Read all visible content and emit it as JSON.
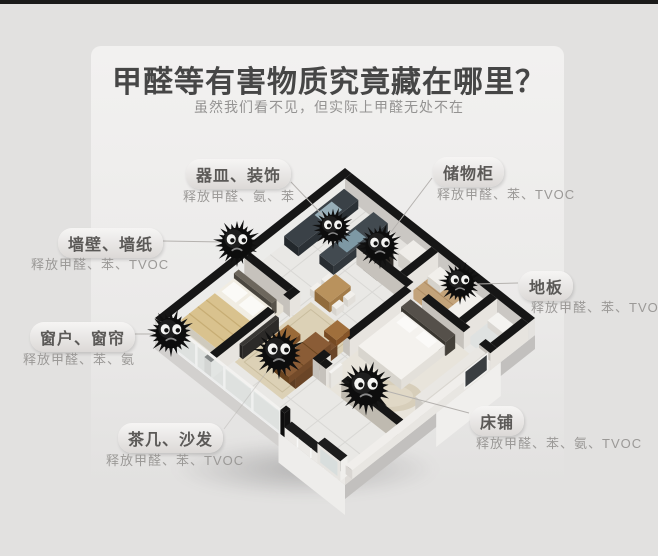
{
  "header": {
    "title": "甲醛等有害物质究竟藏在哪里？",
    "subtitle": "虽然我们看不见，但实际上甲醛无处不在"
  },
  "labels": [
    {
      "id": "vessels",
      "name": "器皿、装饰",
      "release": "释放甲醛、氨、苯"
    },
    {
      "id": "cabinet",
      "name": "储物柜",
      "release": "释放甲醛、苯、TVOC"
    },
    {
      "id": "wall",
      "name": "墙壁、墙纸",
      "release": "释放甲醛、苯、TVOC"
    },
    {
      "id": "floor",
      "name": "地板",
      "release": "释放甲醛、苯、TVOC"
    },
    {
      "id": "window",
      "name": "窗户、窗帘",
      "release": "释放甲醛、苯、氨"
    },
    {
      "id": "sofa",
      "name": "茶几、沙发",
      "release": "释放甲醛、苯、TVOC"
    },
    {
      "id": "bed",
      "name": "床铺",
      "release": "释放甲醛、苯、氨、TVOC"
    }
  ],
  "illustration": {
    "type": "isometric-apartment-cutaway",
    "pollutant_monster_count": 7
  },
  "colors": {
    "background": "#e2e1e0",
    "title_text": "#464646",
    "subtitle_text": "#949392",
    "pill_text": "#5b5957",
    "release_text": "#9b9997",
    "wall_top": "#161616",
    "leader_line": "#b5b2af"
  }
}
